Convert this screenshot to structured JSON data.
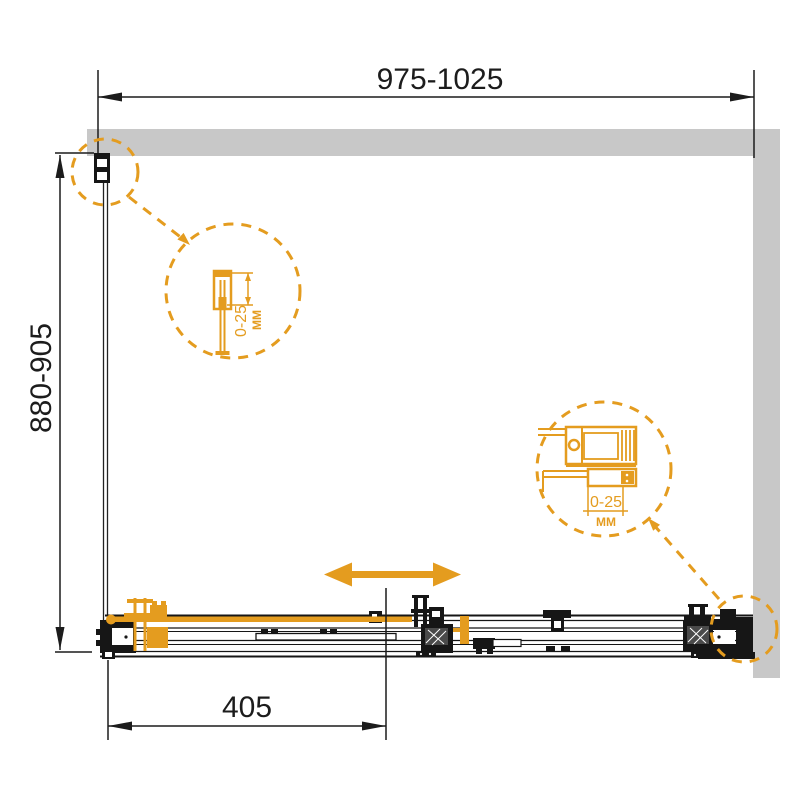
{
  "diagram": {
    "colors": {
      "accent": "#E49C1F",
      "wall_gray": "#C8C8C8",
      "line_black": "#161616"
    },
    "dimensions": {
      "top_width": "975-1025",
      "side_height": "880-905",
      "bottom_offset": "405"
    },
    "callouts": {
      "wall_profile": {
        "adjust_range": "0-25",
        "unit": "ММ"
      },
      "roller_bracket": {
        "adjust_range": "0-25",
        "unit": "ММ"
      }
    },
    "icons": {
      "slide_direction_arrow": "double-headed horizontal arrow"
    }
  }
}
